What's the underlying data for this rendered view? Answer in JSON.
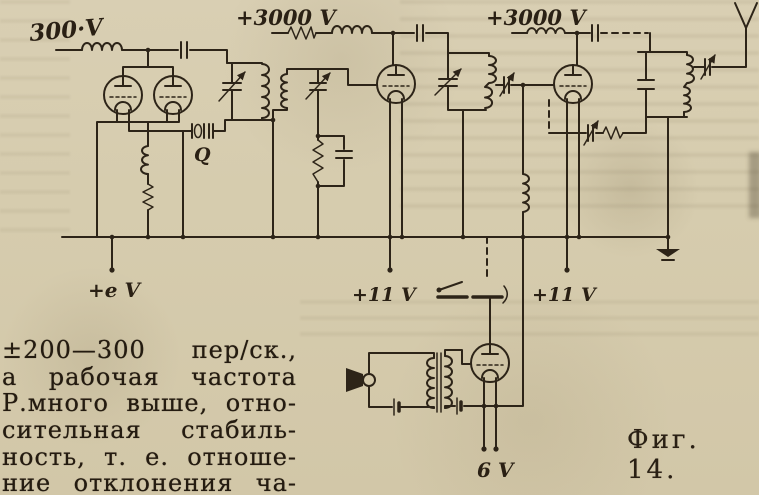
{
  "figure": {
    "caption": "Фиг. 14."
  },
  "schematic": {
    "labels": {
      "oscillator_supply": "300·V",
      "amplifier_supply": "+3000 V",
      "output_supply": "+3000 V",
      "grid_bias_terminal": "+e V",
      "filament_terminal_left": "+11 V",
      "filament_terminal_right": "+11 V",
      "modulator_filament": "6 V",
      "quartz_crystal": "Q"
    },
    "symbols": [
      "vacuum-tube",
      "vacuum-tube",
      "vacuum-tube",
      "vacuum-tube",
      "quartz-crystal",
      "telegraph-key",
      "microphone",
      "modulation-transformer",
      "antenna",
      "ground",
      "rf-choke",
      "tank-circuit",
      "variable-capacitor",
      "capacitor",
      "resistor",
      "battery"
    ]
  },
  "paragraph": {
    "lines": [
      "±200—300 пер/ск.,",
      "а рабочая частота",
      "Р.много выше, отно-",
      "сительная стабиль-",
      "ность, т. е. отноше-",
      "ние отклонения ча-"
    ]
  },
  "colors": {
    "paper": "#d6ccae",
    "ink": "#2d2418"
  }
}
